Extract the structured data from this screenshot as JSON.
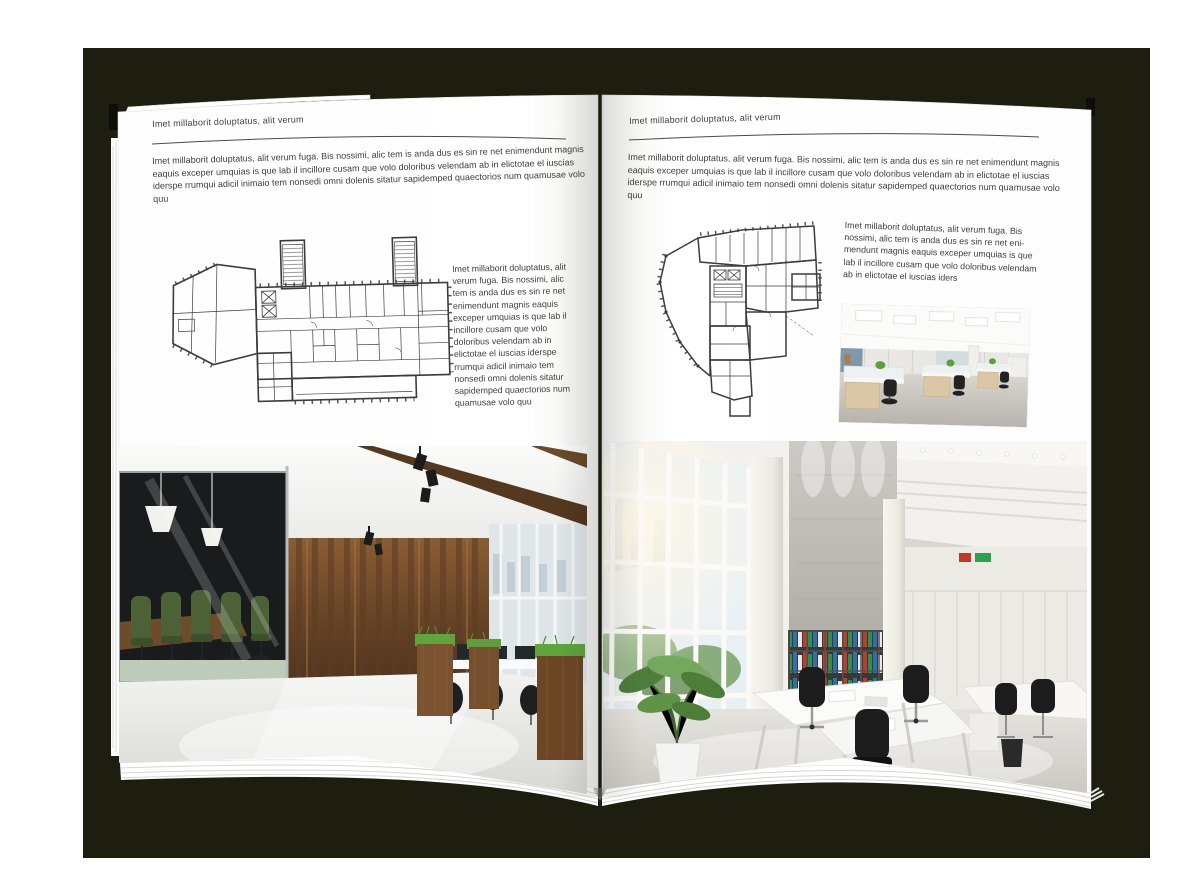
{
  "colors": {
    "backdrop": "#1d1e10",
    "page": "#ffffff",
    "text": "#3e3e3e",
    "plan_ink": "#3c3c3c",
    "wood_accent": "#6b4a2c",
    "plant_green": "#5f9e3c"
  },
  "left_page": {
    "header": "Imet millaborit doluptatus, alit verum",
    "intro": "Imet millaborit doluptatus, alit verum fuga. Bis nossimi, alic tem is anda dus es sin re net enimendunt magnis eaquis exceper umquias is que lab il incillore cusam que volo doloribus velendam ab in elictotae el iuscias iderspe rrumqui adicil inimaio tem nonsedi omni dolenis sitatur sapidemped quaectorios num quamusae volo quu",
    "side_text": "Imet millaborit doluptatus, alit verum fuga. Bis nossimi, alic tem is anda dus es sin re net enimendunt magnis eaquis exceper umquias is que lab il incillore cusam que volo doloribus velendam ab in elictotae el iuscias iderspe rrumqui adicil inimaio tem nonsedi omni dolenis sitatur sapidemped quaectorios num quamusae volo quu",
    "floor_plan": "rectangular-office-building-floor-plan",
    "photo": "loft-office-interior-photo"
  },
  "right_page": {
    "header": "Imet millaborit doluptatus, alit verum",
    "intro": "Imet millaborit doluptatus, alit verum fuga. Bis nossimi, alic tem is anda dus es sin re net enimendunt magnis eaquis exceper umquias is que lab il incillore cusam que volo doloribus velendam ab in elictotae el iuscias iderspe rrumqui adicil inimaio tem nonsedi omni dolenis sitatur sapidemped quaectorios num quamusae volo quu",
    "side_text": "Imet millaborit doluptatus, alit verum fuga. Bis nossimi, alic tem is anda dus es sin re net eni-mendunt magnis eaquis exceper umquias is que lab il incillore cusam que volo doloribus velendam ab in elictotae el iuscias iders",
    "floor_plan": "irregular-office-building-floor-plan",
    "photo_small": "open-plan-office-photo",
    "photo_large": "atrium-office-interior-photo"
  }
}
